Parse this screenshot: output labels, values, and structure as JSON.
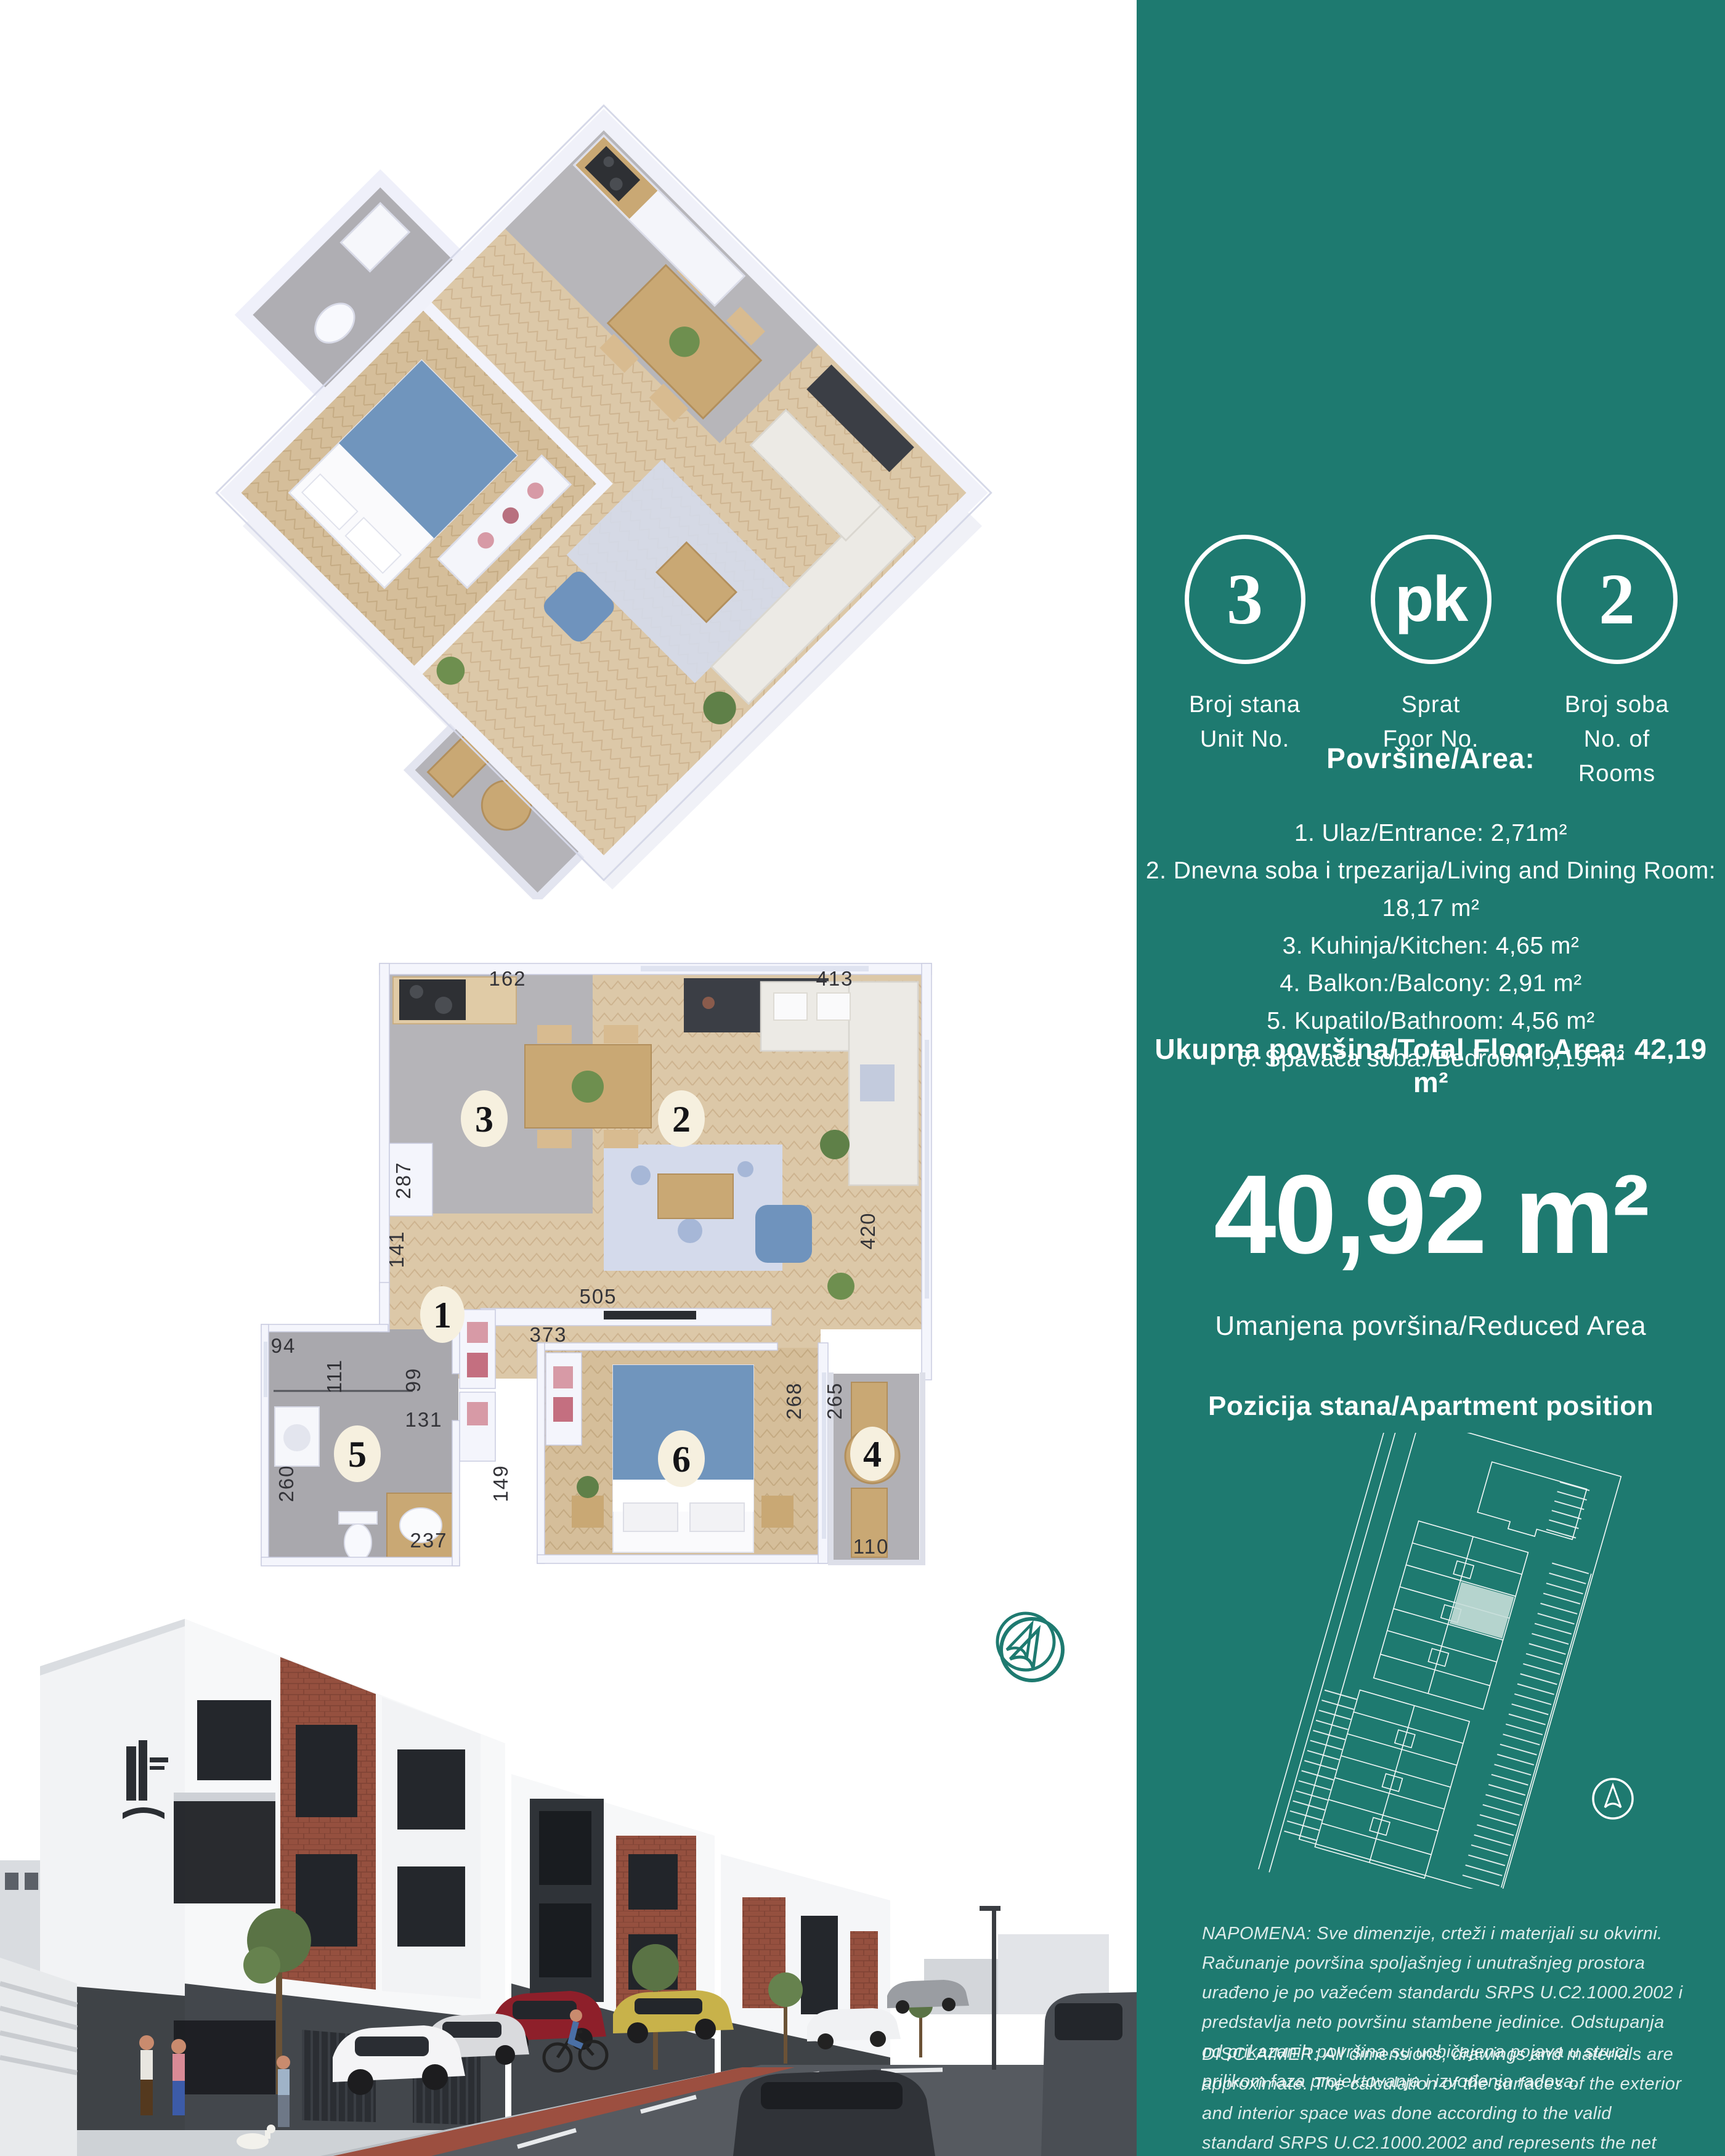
{
  "panel": {
    "badges": [
      {
        "value": "3",
        "label_sr": "Broj stana",
        "label_en": "Unit No."
      },
      {
        "value": "pk",
        "label_sr": "Sprat",
        "label_en": "Foor No."
      },
      {
        "value": "2",
        "label_sr": "Broj soba",
        "label_en": "No. of Rooms"
      }
    ],
    "areas_heading": "Površine/Area:",
    "areas": [
      "1. Ulaz/Entrance: 2,71m²",
      "2. Dnevna soba i trpezarija/Living  and Dining Room: 18,17 m²",
      "3. Kuhinja/Kitchen: 4,65 m²",
      "4. Balkon:/Balcony: 2,91 m²",
      "5. Kupatilo/Bathroom: 4,56 m²",
      "6. Spavaća soba:/Bedroom 9,19 m²"
    ],
    "total": "Ukupna površina/Total Floor Area: 42,19 m²",
    "reduced_value": "40,92 m²",
    "reduced_label": "Umanjena površina/Reduced Area",
    "position_label": "Pozicija stana/Apartment position",
    "napomena": "NAPOMENA: Sve dimenzije, crteži i materijali su okvirni. Računanje površina spoljašnjeg i unutrašnjeg prostora urađeno je po važećem standardu SRPS U.C2.1000.2002 i predstavlja neto površinu stambene jedinice. Odstupanja od prikazanih površina su uobičajena pojava u struci prilikom faza projektovanja i izvođenja radova.",
    "disclaimer": "DISCLAIMER: All dimensions, drawings and materials are approximate. The calculation of the surfaces of the exterior and interior space was done according to the valid standard SRPS U.C2.1000.2002 and represents the net surfaces area of the residential unit. Deviations from the shown surfaces are a common occurance in the profession during the design and construction phases."
  },
  "plan": {
    "dims": {
      "d162": "162",
      "d413": "413",
      "d287": "287",
      "d141": "141",
      "d420": "420",
      "d505": "505",
      "d373": "373",
      "d94": "94",
      "d111": "111",
      "d99": "99",
      "d131": "131",
      "d260": "260",
      "d149": "149",
      "d237": "237",
      "d268": "268",
      "d265": "265",
      "d110": "110"
    },
    "rooms": {
      "r1": "1",
      "r2": "2",
      "r3": "3",
      "r4": "4",
      "r5": "5",
      "r6": "6"
    }
  },
  "icons": {
    "compass_light": "compass-arrow-icon",
    "compass_dark": "north-arrow-icon",
    "logo": "building-logo-icon"
  },
  "colors": {
    "teal": "#1E7A70",
    "unit_highlight": "#CFE3DF",
    "plan_wood": "#DCC8A8",
    "plan_gray": "#B3B2B6",
    "accent_blue": "#7095BD",
    "brick": "#95503F"
  }
}
